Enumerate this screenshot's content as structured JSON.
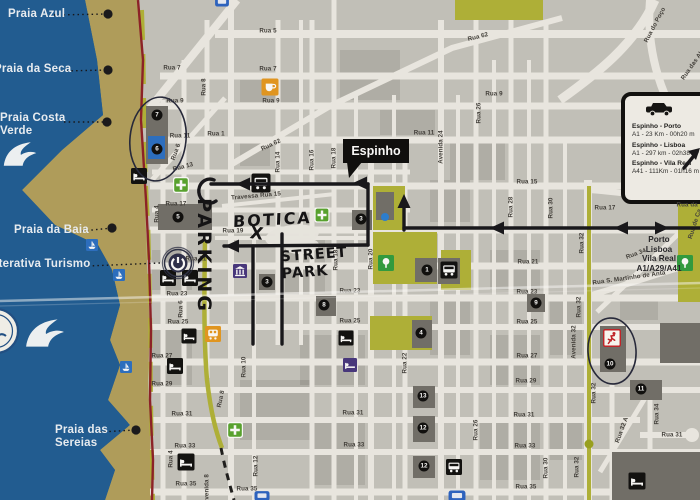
{
  "espinho_flag": "Espinho",
  "info_box": {
    "routes": [
      {
        "name": "Espinho - Porto",
        "detail": "A1 - 23 Km - 00h20 m"
      },
      {
        "name": "Espinho - Lisboa",
        "detail": "A1 - 297 km - 02h38"
      },
      {
        "name": "Espinho - Vila Real",
        "detail": "A41 - 111Km - 01h16 m"
      }
    ]
  },
  "highway_sign": {
    "lines": [
      "Porto",
      "Lisboa",
      "Vila Real",
      "A1/A29/A41"
    ]
  },
  "handwritten": {
    "parking": "PARKING",
    "botica": "BOTICA",
    "x_mark": "X",
    "street_park_1": "STREET",
    "street_park_2": "PARK"
  },
  "beach_labels": [
    {
      "lines": [
        "Praia Azul"
      ],
      "lx": 8,
      "ly": 8,
      "ax": 54,
      "ay": 15,
      "dx": 108,
      "dy": 14,
      "dot": true
    },
    {
      "lines": [
        "Praia da Seca"
      ],
      "lx": -6,
      "ly": 63,
      "ax": 62,
      "ay": 71,
      "dx": 108,
      "dy": 70,
      "dot": true
    },
    {
      "lines": [
        "Praia Costa",
        "Verde"
      ],
      "lx": 0,
      "ly": 112,
      "ax": 64,
      "ay": 122,
      "dx": 107,
      "dy": 122,
      "dot": true
    },
    {
      "lines": [
        "Praia da Baia"
      ],
      "lx": 14,
      "ly": 224,
      "ax": 82,
      "ay": 231,
      "dx": 112,
      "dy": 228,
      "dot": true
    },
    {
      "lines": [
        "Interativa Turismo"
      ],
      "lx": -12,
      "ly": 258,
      "ax": 88,
      "ay": 266,
      "dx": 160,
      "dy": 263,
      "dot": false
    },
    {
      "lines": [
        "Praia das",
        "Sereias"
      ],
      "lx": 55,
      "ly": 424,
      "ax": 100,
      "ay": 432,
      "dx": 136,
      "dy": 430,
      "dot": true
    }
  ],
  "street_labels": [
    {
      "t": "Rua 5",
      "x": 268,
      "y": 31
    },
    {
      "t": "Rua 7",
      "x": 172,
      "y": 68
    },
    {
      "t": "Rua 7",
      "x": 268,
      "y": 69
    },
    {
      "t": "Rua 9",
      "x": 175,
      "y": 101
    },
    {
      "t": "Rua 9",
      "x": 271,
      "y": 101
    },
    {
      "t": "Rua 9",
      "x": 494,
      "y": 94
    },
    {
      "t": "Rua 11",
      "x": 180,
      "y": 136
    },
    {
      "t": "Rua 11",
      "x": 424,
      "y": 133
    },
    {
      "t": "Rua 1",
      "x": 216,
      "y": 134
    },
    {
      "t": "Rua 13",
      "x": 183,
      "y": 167,
      "r": -14
    },
    {
      "t": "Rua 62",
      "x": 271,
      "y": 145,
      "r": -25
    },
    {
      "t": "Rua 62",
      "x": 478,
      "y": 37,
      "r": -14
    },
    {
      "t": "Rua 15",
      "x": 527,
      "y": 182
    },
    {
      "t": "Travessa Rua 15",
      "x": 256,
      "y": 196,
      "r": -5
    },
    {
      "t": "Rua 17",
      "x": 176,
      "y": 204
    },
    {
      "t": "Rua 17",
      "x": 605,
      "y": 208
    },
    {
      "t": "Rua 19",
      "x": 233,
      "y": 231
    },
    {
      "t": "Rua 21",
      "x": 196,
      "y": 259
    },
    {
      "t": "Rua 21",
      "x": 528,
      "y": 262
    },
    {
      "t": "Rua 23",
      "x": 177,
      "y": 294
    },
    {
      "t": "Rua 23",
      "x": 350,
      "y": 291
    },
    {
      "t": "Rua 23",
      "x": 527,
      "y": 292
    },
    {
      "t": "Rua 25",
      "x": 178,
      "y": 322
    },
    {
      "t": "Rua 25",
      "x": 350,
      "y": 321
    },
    {
      "t": "Rua 25",
      "x": 527,
      "y": 322
    },
    {
      "t": "Rua 27",
      "x": 162,
      "y": 356
    },
    {
      "t": "Rua 27",
      "x": 527,
      "y": 356
    },
    {
      "t": "Rua 29",
      "x": 162,
      "y": 384
    },
    {
      "t": "Rua 29",
      "x": 526,
      "y": 381
    },
    {
      "t": "Rua 31",
      "x": 182,
      "y": 414
    },
    {
      "t": "Rua 31",
      "x": 353,
      "y": 413
    },
    {
      "t": "Rua 31",
      "x": 524,
      "y": 415
    },
    {
      "t": "Rua 31",
      "x": 672,
      "y": 435
    },
    {
      "t": "Rua 33",
      "x": 185,
      "y": 446
    },
    {
      "t": "Rua 33",
      "x": 354,
      "y": 445
    },
    {
      "t": "Rua 33",
      "x": 525,
      "y": 446
    },
    {
      "t": "Rua 35",
      "x": 186,
      "y": 484
    },
    {
      "t": "Rua 35",
      "x": 247,
      "y": 489
    },
    {
      "t": "Rua 35",
      "x": 526,
      "y": 487
    },
    {
      "t": "Rua 34",
      "x": 636,
      "y": 254,
      "r": -20
    },
    {
      "t": "Rua S. Martinho de Anta",
      "x": 629,
      "y": 278,
      "r": -8
    },
    {
      "t": "Rua da L",
      "x": 690,
      "y": 205
    },
    {
      "t": "Rua 8",
      "x": 204,
      "y": 87,
      "r": -90
    },
    {
      "t": "Rua 6",
      "x": 176,
      "y": 152,
      "r": -70
    },
    {
      "t": "Rua 6",
      "x": 181,
      "y": 309,
      "r": -90
    },
    {
      "t": "Rua 4",
      "x": 157,
      "y": 214,
      "r": -90
    },
    {
      "t": "Rua 4",
      "x": 171,
      "y": 459,
      "r": -90
    },
    {
      "t": "Rua 14",
      "x": 278,
      "y": 162,
      "r": -90
    },
    {
      "t": "Rua 16",
      "x": 312,
      "y": 160,
      "r": -90
    },
    {
      "t": "Rua 18",
      "x": 334,
      "y": 158,
      "r": -90
    },
    {
      "t": "Rua 18",
      "x": 336,
      "y": 260,
      "r": -90
    },
    {
      "t": "Rua 20",
      "x": 371,
      "y": 259,
      "r": -90
    },
    {
      "t": "Rua 22",
      "x": 405,
      "y": 363,
      "r": -90
    },
    {
      "t": "Avenida 24",
      "x": 441,
      "y": 147,
      "r": -90
    },
    {
      "t": "Rua 26",
      "x": 479,
      "y": 113,
      "r": -90
    },
    {
      "t": "Rua 26",
      "x": 476,
      "y": 430,
      "r": -90
    },
    {
      "t": "Rua 28",
      "x": 511,
      "y": 207,
      "r": -90
    },
    {
      "t": "Rua 30",
      "x": 551,
      "y": 208,
      "r": -90
    },
    {
      "t": "Rua 30",
      "x": 546,
      "y": 468,
      "r": -90
    },
    {
      "t": "Rua 32",
      "x": 582,
      "y": 243,
      "r": -90
    },
    {
      "t": "Rua 32",
      "x": 579,
      "y": 307,
      "r": -90
    },
    {
      "t": "Rua 32",
      "x": 594,
      "y": 393,
      "r": -90
    },
    {
      "t": "Rua 32",
      "x": 577,
      "y": 467,
      "r": -90
    },
    {
      "t": "Avenida 32",
      "x": 574,
      "y": 342,
      "r": -90
    },
    {
      "t": "Rua 32 A",
      "x": 622,
      "y": 430,
      "r": -70
    },
    {
      "t": "Rua 34",
      "x": 657,
      "y": 414,
      "r": -90
    },
    {
      "t": "Rua 10",
      "x": 244,
      "y": 367,
      "r": -90
    },
    {
      "t": "Rua 12",
      "x": 256,
      "y": 466,
      "r": -90
    },
    {
      "t": "Avenida 8",
      "x": 207,
      "y": 489,
      "r": -90
    },
    {
      "t": "Rua 8",
      "x": 221,
      "y": 399,
      "r": -78
    },
    {
      "t": "Rua do Poço",
      "x": 655,
      "y": 25,
      "r": -62
    },
    {
      "t": "Rua das Al",
      "x": 692,
      "y": 66,
      "r": -55
    },
    {
      "t": "Rua de Ca",
      "x": 695,
      "y": 224,
      "r": -72
    }
  ],
  "markers": [
    {
      "n": "7",
      "x": 157,
      "y": 115
    },
    {
      "n": "6",
      "x": 157,
      "y": 149
    },
    {
      "n": "5",
      "x": 178,
      "y": 217
    },
    {
      "n": "3",
      "x": 361,
      "y": 219
    },
    {
      "n": "3",
      "x": 267,
      "y": 282
    },
    {
      "n": "1",
      "x": 427,
      "y": 270
    },
    {
      "n": "4",
      "x": 421,
      "y": 333
    },
    {
      "n": "8",
      "x": 324,
      "y": 305
    },
    {
      "n": "9",
      "x": 536,
      "y": 303
    },
    {
      "n": "10",
      "x": 610,
      "y": 364
    },
    {
      "n": "11",
      "x": 641,
      "y": 389
    },
    {
      "n": "13",
      "x": 423,
      "y": 396
    },
    {
      "n": "12",
      "x": 423,
      "y": 428
    },
    {
      "n": "12",
      "x": 424,
      "y": 466
    }
  ],
  "pois": [
    {
      "type": "hotel",
      "x": 139,
      "y": 176,
      "s": 16
    },
    {
      "type": "hotel",
      "x": 168,
      "y": 278,
      "s": 16
    },
    {
      "type": "hotel",
      "x": 190,
      "y": 278,
      "s": 16
    },
    {
      "type": "hotel",
      "x": 189,
      "y": 336,
      "s": 15
    },
    {
      "type": "hotel",
      "x": 175,
      "y": 366,
      "s": 16
    },
    {
      "type": "hotel",
      "x": 186,
      "y": 462,
      "s": 17
    },
    {
      "type": "hotel",
      "x": 346,
      "y": 338,
      "s": 15
    },
    {
      "type": "hotel",
      "x": 637,
      "y": 481,
      "s": 17
    },
    {
      "type": "bus",
      "x": 449,
      "y": 270,
      "s": 17
    },
    {
      "type": "bus",
      "x": 454,
      "y": 467,
      "s": 16
    },
    {
      "type": "bus",
      "x": 261,
      "y": 183,
      "s": 19
    },
    {
      "type": "pharmacy",
      "x": 181,
      "y": 185,
      "s": 16
    },
    {
      "type": "pharmacy",
      "x": 322,
      "y": 215,
      "s": 15
    },
    {
      "type": "pharmacy",
      "x": 235,
      "y": 430,
      "s": 16
    },
    {
      "type": "cafe",
      "x": 270,
      "y": 87,
      "s": 17
    },
    {
      "type": "train",
      "x": 213,
      "y": 334,
      "s": 16
    },
    {
      "type": "library",
      "x": 240,
      "y": 271,
      "s": 14
    },
    {
      "type": "hostel",
      "x": 350,
      "y": 365,
      "s": 14
    },
    {
      "type": "boat",
      "x": 92,
      "y": 245,
      "s": 12
    },
    {
      "type": "boat",
      "x": 119,
      "y": 275,
      "s": 12
    },
    {
      "type": "boat",
      "x": 126,
      "y": 367,
      "s": 12
    },
    {
      "type": "tree",
      "x": 386,
      "y": 263,
      "s": 16
    },
    {
      "type": "tree",
      "x": 685,
      "y": 263,
      "s": 16
    },
    {
      "type": "runner",
      "x": 612,
      "y": 338,
      "s": 18
    },
    {
      "type": "power",
      "x": 178,
      "y": 263,
      "s": 34
    },
    {
      "type": "wave",
      "x": 20,
      "y": 154,
      "s": 36
    },
    {
      "type": "wave",
      "x": 45,
      "y": 333,
      "s": 42
    },
    {
      "type": "logo",
      "x": -4,
      "y": 331,
      "s": 48
    },
    {
      "type": "bluecut",
      "x": 262,
      "y": 496,
      "s": 15
    },
    {
      "type": "bluecut",
      "x": 457,
      "y": 496,
      "s": 17
    },
    {
      "type": "bluecut",
      "x": 222,
      "y": 2,
      "s": 14
    }
  ],
  "colors": {
    "ocean": "#1e5c95",
    "sand": "#b3a05c",
    "map_bg": "#c6c4be",
    "street": "#efede7",
    "lime": "#b1b437",
    "park_green": "#2f9e3f",
    "pharmacy_green": "#57a52e",
    "orange": "#e6981f",
    "purple": "#46357f",
    "blue": "#2a6fc4",
    "coast_road": "#8e1f26",
    "building": "#716f6a",
    "ink": "#15151a"
  }
}
